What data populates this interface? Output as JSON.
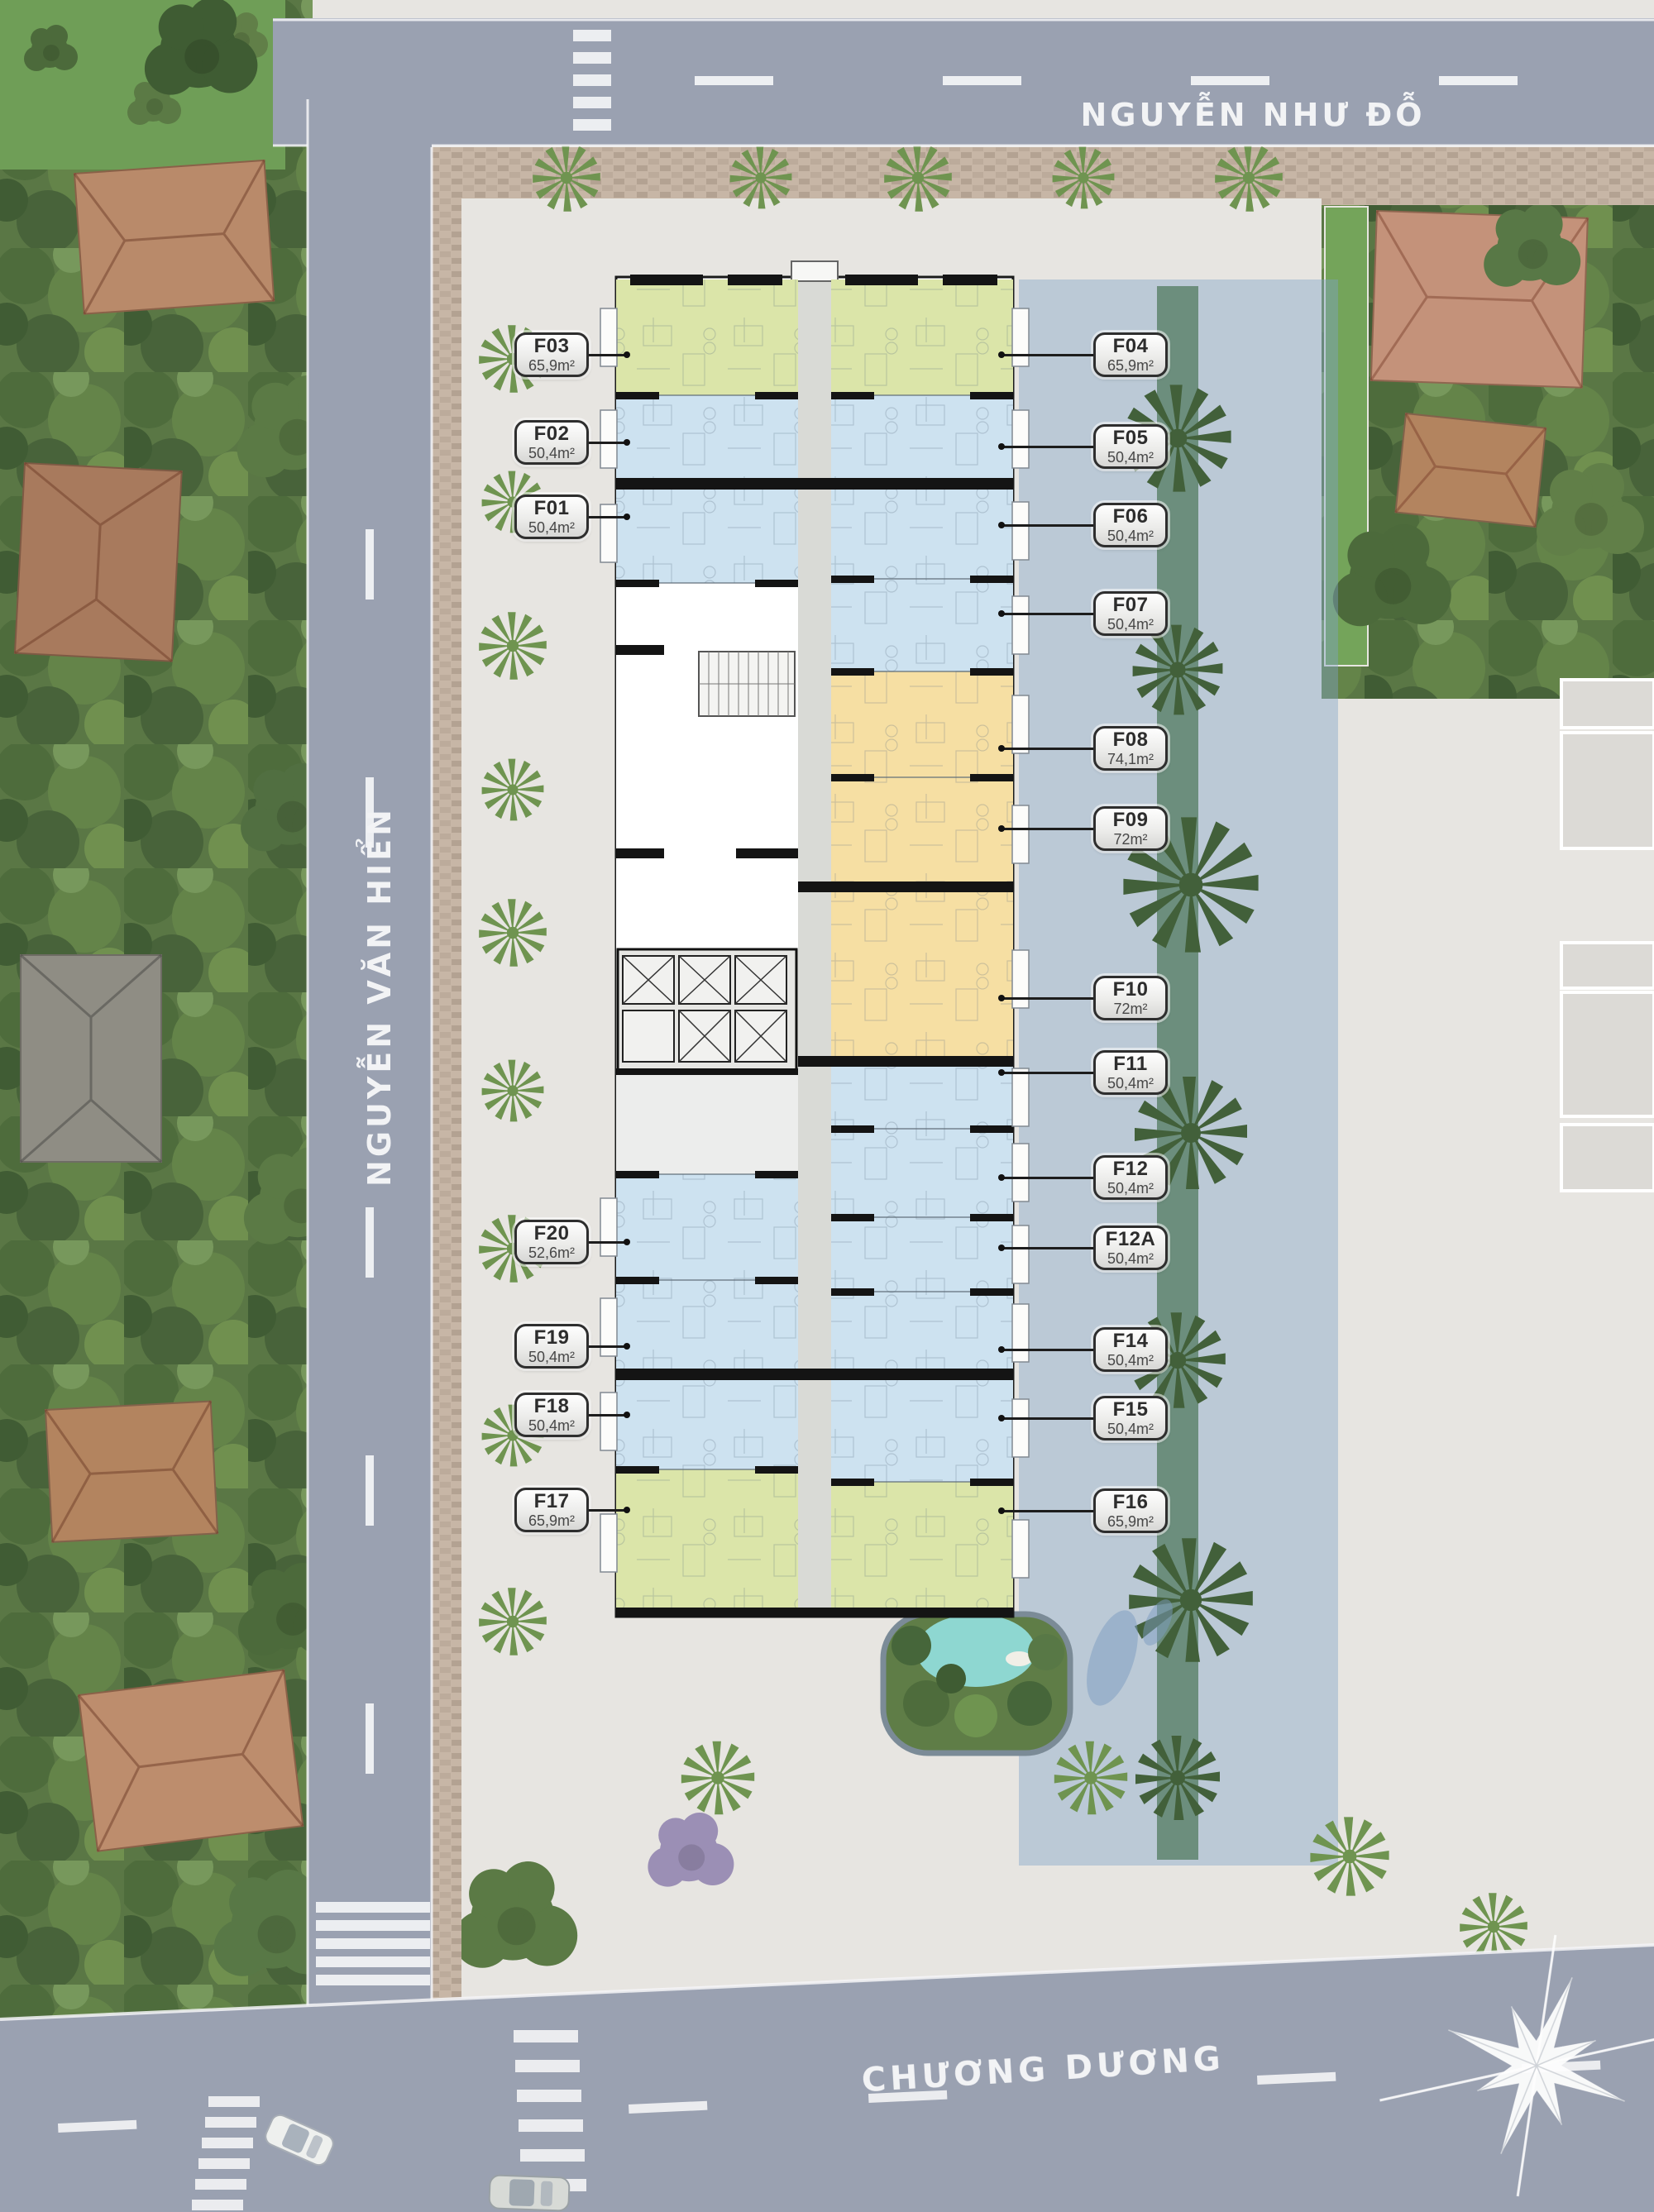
{
  "title": "Apartment tower typical floor plan on aerial site map",
  "streets": {
    "top": "NGUYỄN NHƯ ĐỖ",
    "left": "NGUYỄN VĂN HIỂN",
    "bottom": "CHƯƠNG DƯƠNG"
  },
  "units": [
    {
      "id": "F01",
      "area": "50,4m²",
      "side": "left",
      "type": "blue"
    },
    {
      "id": "F02",
      "area": "50,4m²",
      "side": "left",
      "type": "blue"
    },
    {
      "id": "F03",
      "area": "65,9m²",
      "side": "left",
      "type": "green"
    },
    {
      "id": "F04",
      "area": "65,9m²",
      "side": "right",
      "type": "green"
    },
    {
      "id": "F05",
      "area": "50,4m²",
      "side": "right",
      "type": "blue"
    },
    {
      "id": "F06",
      "area": "50,4m²",
      "side": "right",
      "type": "blue"
    },
    {
      "id": "F07",
      "area": "50,4m²",
      "side": "right",
      "type": "blue"
    },
    {
      "id": "F08",
      "area": "74,1m²",
      "side": "right",
      "type": "orange"
    },
    {
      "id": "F09",
      "area": "72m²",
      "side": "right",
      "type": "orange"
    },
    {
      "id": "F10",
      "area": "72m²",
      "side": "right",
      "type": "orange"
    },
    {
      "id": "F11",
      "area": "50,4m²",
      "side": "right",
      "type": "blue"
    },
    {
      "id": "F12",
      "area": "50,4m²",
      "side": "right",
      "type": "blue"
    },
    {
      "id": "F12A",
      "area": "50,4m²",
      "side": "right",
      "type": "blue"
    },
    {
      "id": "F14",
      "area": "50,4m²",
      "side": "right",
      "type": "blue"
    },
    {
      "id": "F15",
      "area": "50,4m²",
      "side": "right",
      "type": "blue"
    },
    {
      "id": "F16",
      "area": "65,9m²",
      "side": "right",
      "type": "green"
    },
    {
      "id": "F17",
      "area": "65,9m²",
      "side": "left",
      "type": "green"
    },
    {
      "id": "F18",
      "area": "50,4m²",
      "side": "left",
      "type": "blue"
    },
    {
      "id": "F19",
      "area": "50,4m²",
      "side": "left",
      "type": "blue"
    },
    {
      "id": "F20",
      "area": "52,6m²",
      "side": "left",
      "type": "blue"
    }
  ],
  "palette": {
    "unit_green": "#dbe5a9",
    "unit_blue": "#cde2f0",
    "unit_orange": "#f6dfa3",
    "corridor_gray": "#d9dad6",
    "road_gray": "#9aa1b1",
    "water_overlay_blue": "#7fa3c8",
    "pool_turquoise": "#8ed7d1",
    "foliage_green": "#5a7745",
    "label_border": "#2e2e2e"
  },
  "icons": {
    "compass": "compass-rose-icon",
    "palm": "palm-tree-icon",
    "pool": "swimming-pool"
  }
}
